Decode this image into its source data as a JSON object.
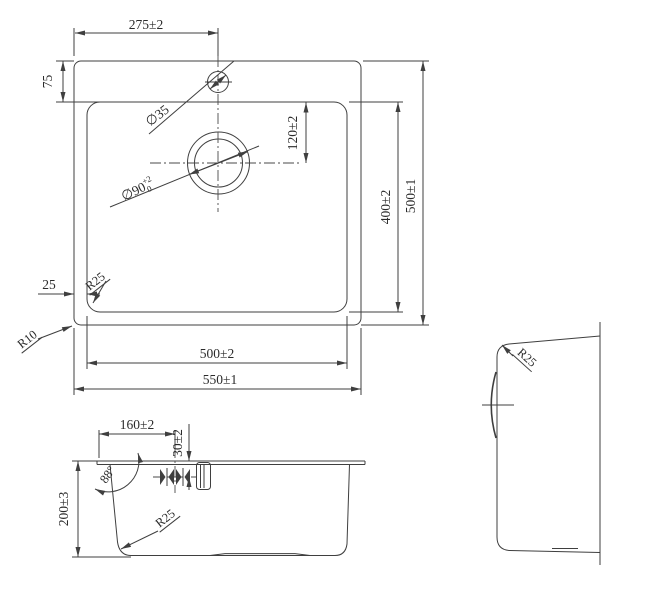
{
  "drawing": {
    "type": "sink-dimension-drawing",
    "colors": {
      "line": "#3f3f3f",
      "text": "#2b2b2b",
      "background": "#ffffff"
    },
    "top_view": {
      "hole_offset": "275±2",
      "rim_to_bowl": "75",
      "hole_diameter": "∅35",
      "drain_offset": "120±2",
      "drain_diameter": "∅90",
      "drain_tol_plus": "+2",
      "drain_tol_minus": "0",
      "bowl_length": "400±2",
      "outer_length": "500±1",
      "rim_side": "25",
      "bowl_corner_radius": "R25",
      "outer_corner_radius": "R10",
      "bowl_width": "500±2",
      "outer_width": "550±1"
    },
    "front_view": {
      "drain_position": "160±2",
      "drain_drop": "30±2",
      "wall_angle": "88°",
      "bowl_depth": "200±3",
      "bottom_corner_radius": "R25"
    },
    "side_view": {
      "corner_radius": "R25"
    }
  }
}
